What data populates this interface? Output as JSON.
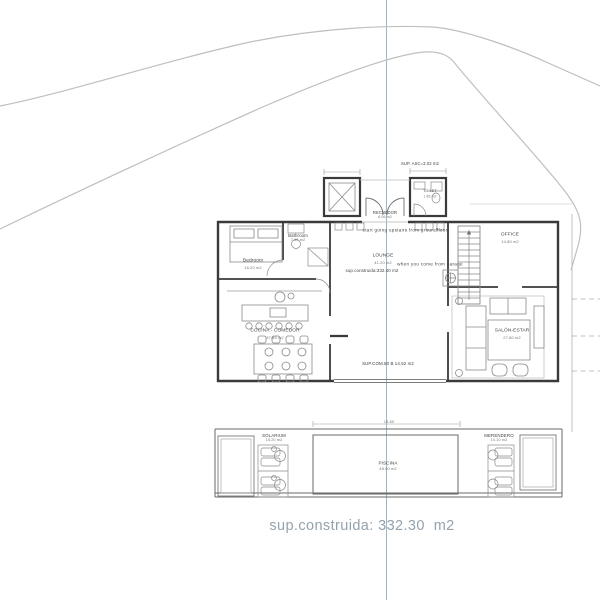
{
  "colors": {
    "centerline": "#9bb9c0",
    "road": "#bfbfbf",
    "wall": "#3a3a3a",
    "thin_line": "#8a8a8a",
    "footer_text": "#94a2ad"
  },
  "site": {
    "sup_asc": "SUP. ASC=3.02 m2"
  },
  "entry": {
    "recibidor": {
      "name": "RECIBIDOR",
      "area": "8.06 m2"
    },
    "toilet": {
      "name": "TOILET",
      "area": "1.85 m2"
    },
    "note_upstairs": "start going upstairs from groundfloor",
    "note_garage": "when you come from garage"
  },
  "rooms": {
    "bedroom": {
      "name": "Bedroom",
      "area": "16.20 m2"
    },
    "bathroom": {
      "name": "Bathroom",
      "area": "7.65 m2"
    },
    "lounge": {
      "name": "LOUNGE",
      "area": "41.20 m2"
    },
    "office": {
      "name": "OFFICE",
      "area": "14.80 m2"
    },
    "cocina": {
      "name": "COCINA - COMEDOR",
      "area": "37.85 m2"
    },
    "salon": {
      "name": "SALÓN-ESTAR",
      "area": "27.80 m2"
    }
  },
  "notes": {
    "sup_construida_inner": "sup.construida:332.40 m2",
    "sup_com": "SUP.COM.50 B 14.52 m2"
  },
  "outdoor": {
    "solarium": {
      "name": "SOLARIUM",
      "area": "15.20 m2"
    },
    "merendero": {
      "name": "MERENDERO",
      "area": "14.10 m2"
    },
    "piscina": {
      "name": "PISCINA",
      "area": "48.00 m2"
    },
    "deck_dim": "13.60"
  },
  "footer": {
    "text": "sup.construida: 332.30  m2"
  }
}
